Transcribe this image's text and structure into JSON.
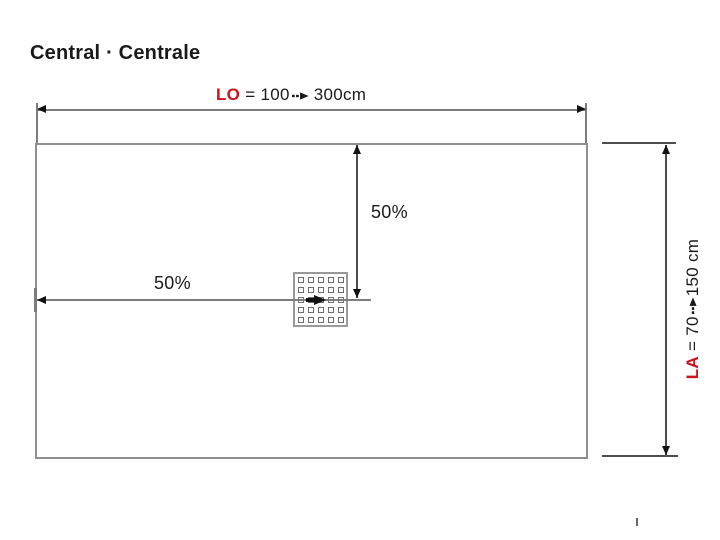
{
  "title": "Central · Centrale",
  "dimensions": {
    "length": {
      "code": "LO",
      "equals": "=",
      "from": "100",
      "to": "300cm"
    },
    "width": {
      "code": "LA",
      "equals": "=",
      "from": "70",
      "to": "150 cm"
    }
  },
  "drain": {
    "horizontal_position_label": "50%",
    "vertical_position_label": "50%",
    "grid_rows": 5,
    "grid_cols": 5
  },
  "colors": {
    "accent_red": "#cf121b",
    "tray_border": "#8f8f8f",
    "dimension_line": "#4d4d4d",
    "light_line": "#7d7d7d",
    "text": "#1a1a1a"
  }
}
